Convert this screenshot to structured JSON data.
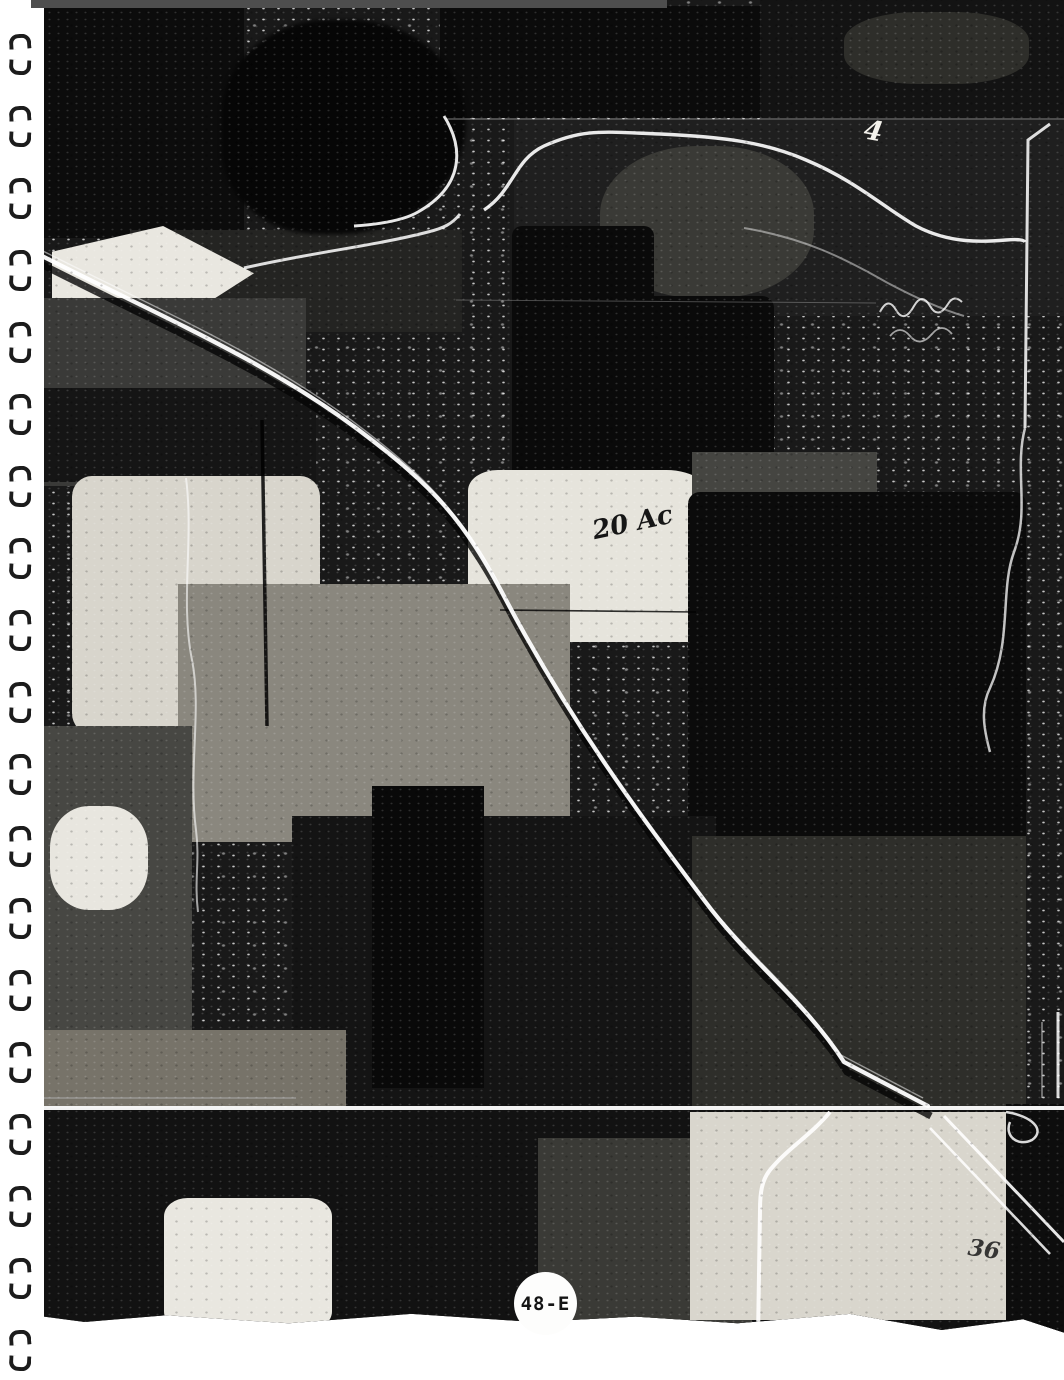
{
  "sheet": {
    "label": "48-E"
  },
  "annotations": {
    "acreage": "20 Ac",
    "numeral": "4",
    "section_number": "36"
  },
  "binding": {
    "pairs": 19
  },
  "colors": {
    "paper": "#ffffff",
    "photo_dark": "#111111",
    "photo_light": "#f2f0ea",
    "label_circle_fill": "#fdfdfc",
    "label_text": "#141414",
    "scan_bar": "#4e4e4e",
    "binding_marks": "#1c1c1c"
  }
}
